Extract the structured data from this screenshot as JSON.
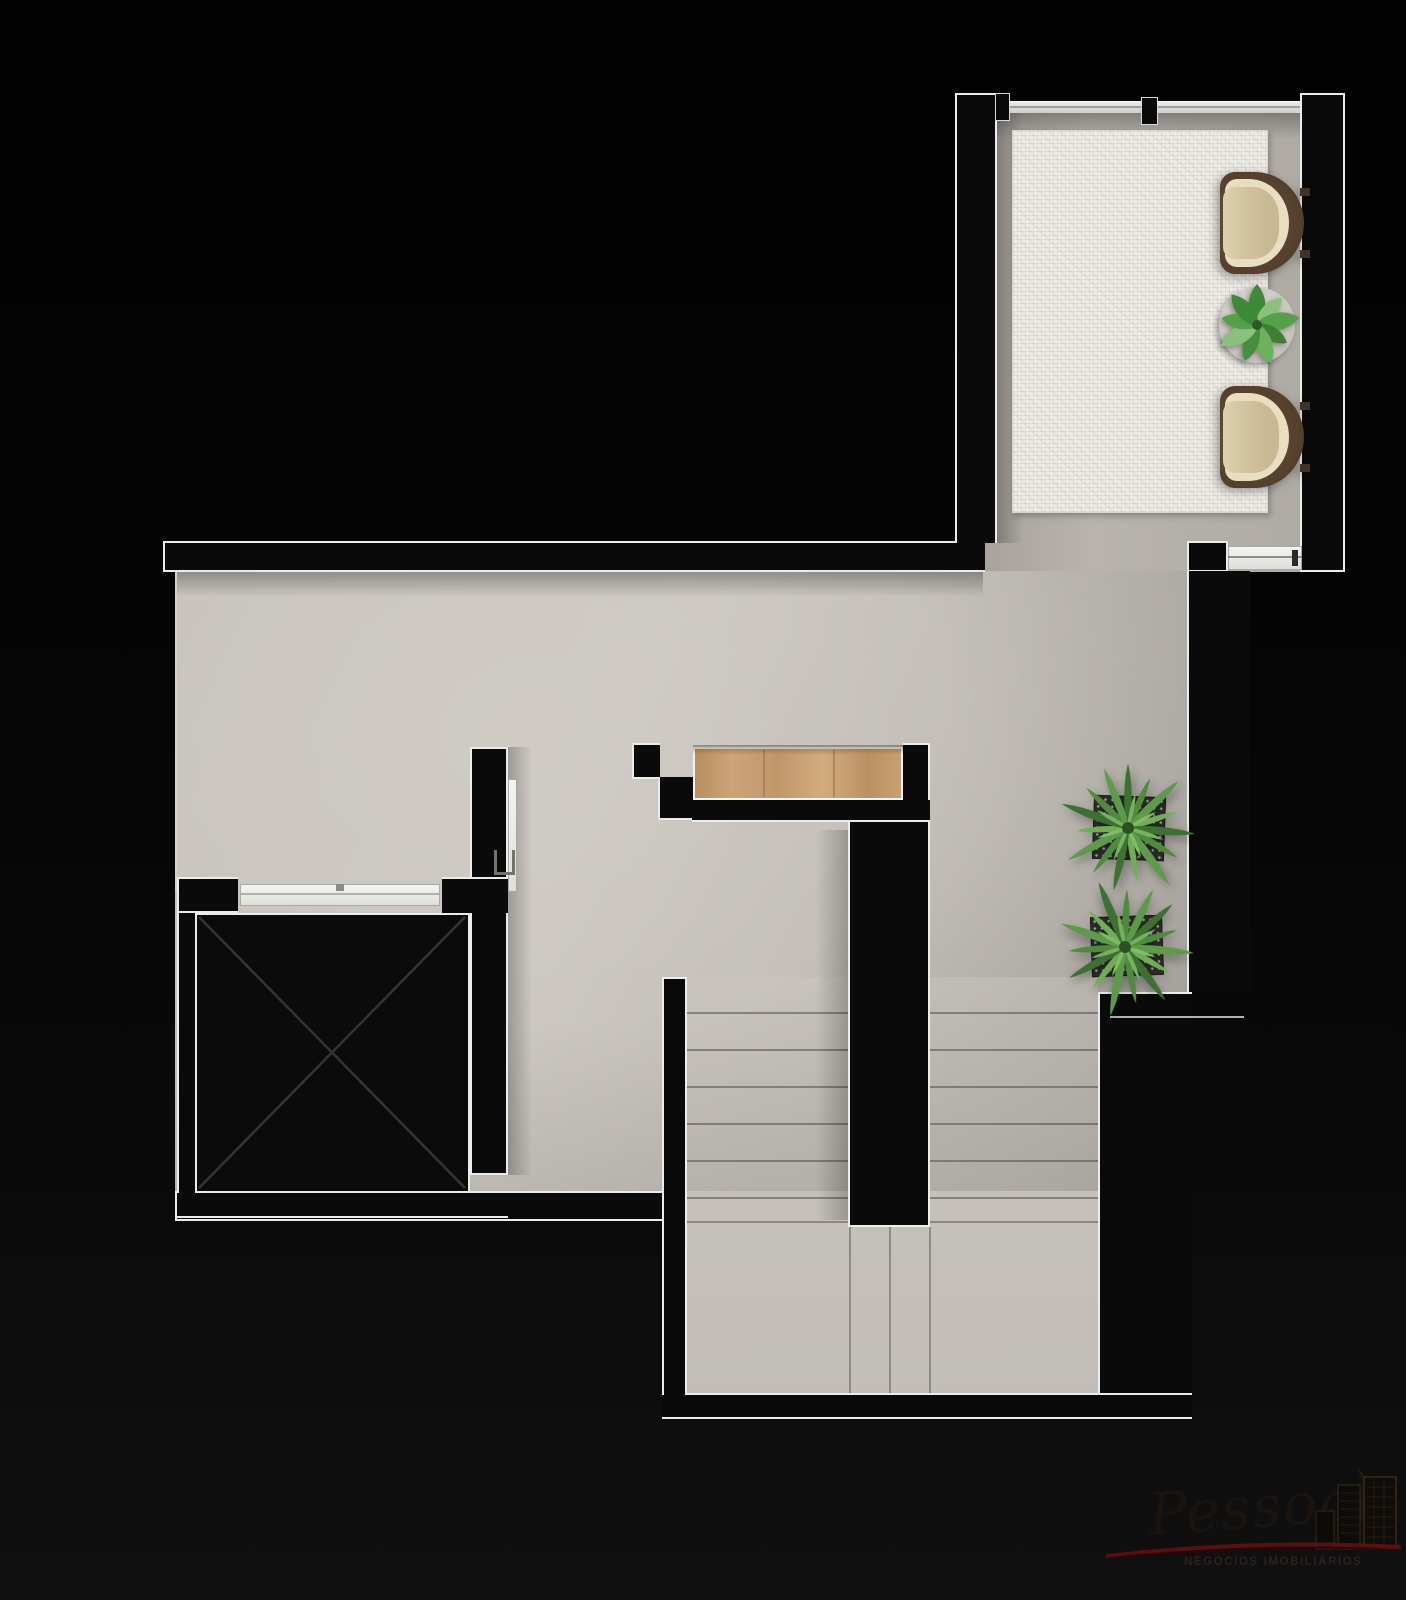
{
  "image_type": "top-down architectural floor plan render on black background",
  "watermark": {
    "brand": "Pessoal",
    "tagline": "NEGÓCIOS IMOBILIÁRIOS",
    "swoosh_color": "#5f1013",
    "buildings_icon": "city-buildings-icon"
  },
  "palette": {
    "background": "#050505",
    "wall_fill": "#0a0a0a",
    "wall_outline": "#ececec",
    "floor_main": "#c7c2bc",
    "floor_room": "#b3aea8",
    "rug": "#efede8",
    "wood_cabinet": "#c29a6e",
    "plant_green": "#4f8a3e",
    "chair_brown": "#5f4a36",
    "chair_cushion": "#d6c6a4"
  },
  "plan_elements": {
    "upper_room": "sitting terrace with textured rug",
    "armchairs": "two brown lounge armchairs facing left",
    "side_table": "round table with potted plant",
    "window": "glazed strip with mullion posts",
    "sliding_doors": "two white sliding door leaves",
    "elevator": "shaft crossed with X, front doors",
    "cabinet": "built-in wood closet at stair head",
    "staircase": "U-shaped stair, two flights around center wall",
    "planters": "two spiky plants in square planters"
  },
  "icons": [
    "elevator-x-icon",
    "stairs-icon",
    "spiky-plant-icon",
    "potted-plant-icon",
    "armchair-icon",
    "door-handle-icon",
    "city-buildings-icon"
  ]
}
